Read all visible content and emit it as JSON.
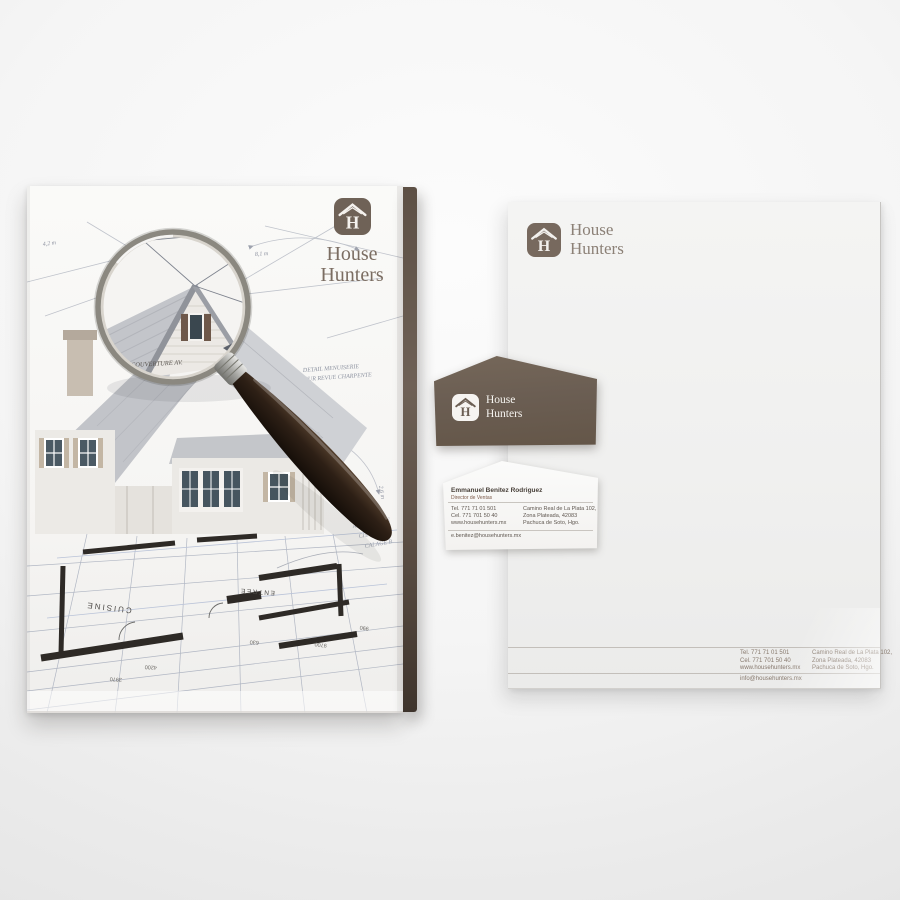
{
  "brand": {
    "monogram": "H",
    "name_line1": "House",
    "name_line2": "Hunters",
    "colors": {
      "brown": "#6b5e53",
      "brown_dark": "#4a3e35",
      "muted_text": "#8c8177"
    }
  },
  "folder_cover": {
    "sketch_notes": {
      "note1_line1": "DETAIL MENUISERIE",
      "note1_line2": "SUR REVUE CHARPENTE",
      "note2_line1": "ALTERNATIVE",
      "note2_line2": "CHANGE M.",
      "note2_line3": "CALAGE B.",
      "glass_note": "COUVERTURE AV.",
      "dim_a": "8,1 m",
      "dim_b": "4,2 m",
      "dim_c": "2,6 m"
    },
    "floor_plan": {
      "room1": "CUISINE",
      "room2": "ENTREE",
      "dim1": "4200",
      "dim2": "3970",
      "dim3": "630",
      "dim4": "9700",
      "dim5": "990"
    }
  },
  "letterhead": {
    "footer": {
      "tel": "Tel. 771 71 01 501",
      "cel": "Cel. 771 701 50 40",
      "website": "www.househunters.mx",
      "address_line1": "Camino Real de La Plata 102,",
      "address_line2": "Zona Plateada, 42083",
      "address_line3": "Pachuca de Soto, Hgo.",
      "email": "info@househunters.mx"
    }
  },
  "business_card_back": {
    "name": "Emmanuel Benitez Rodriguez",
    "title": "Director de Ventas",
    "tel": "Tel. 771 71 01 501",
    "cel": "Cel. 771 701 50 40",
    "website": "www.househunters.mx",
    "address_line1": "Camino Real de La Plata 102,",
    "address_line2": "Zona Plateada, 42083",
    "address_line3": "Pachuca de Soto, Hgo.",
    "email": "e.benitez@househunters.mx"
  }
}
